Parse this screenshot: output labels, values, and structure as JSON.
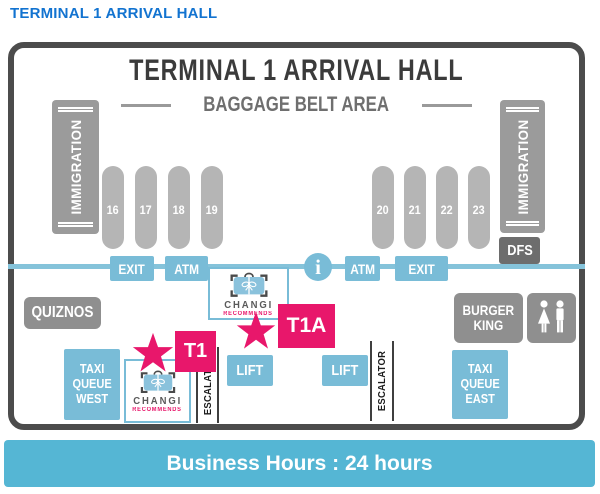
{
  "page": {
    "title": "TERMINAL 1 ARRIVAL HALL"
  },
  "map": {
    "title": "TERMINAL 1 ARRIVAL HALL",
    "subtitle": "BAGGAGE BELT AREA",
    "immigration": "IMMIGRATION",
    "belts_left": [
      "16",
      "17",
      "18",
      "19"
    ],
    "belts_right": [
      "20",
      "21",
      "22",
      "23"
    ],
    "exit": "EXIT",
    "atm": "ATM",
    "info": "i",
    "dfs": "DFS",
    "quiznos": "QUIZNOS",
    "burger_king": {
      "line1": "BURGER",
      "line2": "KING"
    },
    "taxi_west": {
      "line1": "TAXI",
      "line2": "QUEUE",
      "line3": "WEST"
    },
    "taxi_east": {
      "line1": "TAXI",
      "line2": "QUEUE",
      "line3": "EAST"
    },
    "lift": "LIFT",
    "escalator": "ESCALATOR",
    "booth": {
      "name": "CHANGI",
      "sub": "RECOMMENDS"
    },
    "markers": {
      "t1": "T1",
      "t1a": "T1A"
    }
  },
  "footer": {
    "business_hours": "Business Hours : 24 hours"
  },
  "colors": {
    "header_blue": "#1273d0",
    "map_blue": "#79bcd7",
    "bar_blue": "#55b6d4",
    "pink": "#e8176b",
    "gray": "#8f8f8f",
    "dark_gray": "#6d6d6d",
    "frame_border": "#4c4c4c",
    "belt_gray": "#b5b5b5"
  }
}
